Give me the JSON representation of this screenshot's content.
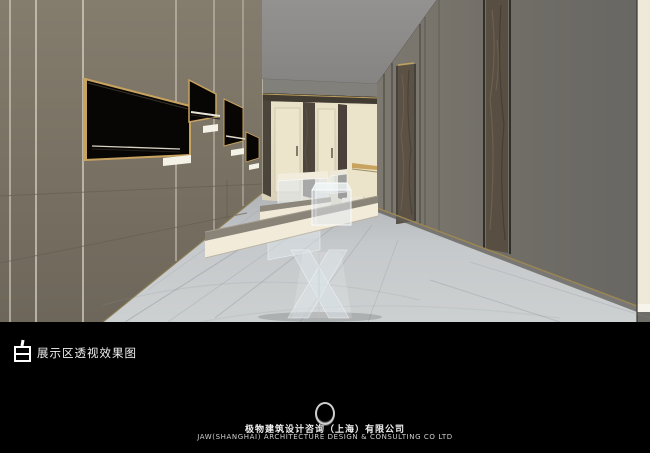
{
  "title_bar": {
    "icon": "bai-square-logo-icon",
    "label": "展示区透视效果图"
  },
  "footer": {
    "logo": "ring-enso-logo-icon",
    "company_cn": "极物建筑设计咨询（上海）有限公司",
    "company_en": "JAW(SHANGHAI) ARCHITECTURE DESIGN & CONSULTING CO LTD"
  },
  "rendering": {
    "type": "interior-perspective-rendering",
    "subject": "exhibition area corridor: left display wall with gold-framed black niches, cream back wall with bronze pilasters, glass vitrines and display table on marble floor, gray wardrobe wall with stone columns on the right",
    "colors": {
      "page_black": "#000000",
      "left_wall_taupe": "#7b7466",
      "ceiling_gray": "#8d8c8a",
      "back_wall_cream": "#e7dfc6",
      "bronze_pilaster": "#46403a",
      "gold_frame": "#c8a35f",
      "niche_black": "#080604",
      "marble_floor": "#c4c7ca",
      "right_wall_gray": "#716e67",
      "stone_column": "#5a5044",
      "glass_tint": "#dde6ea",
      "label_white": "#f4f1e7"
    }
  }
}
